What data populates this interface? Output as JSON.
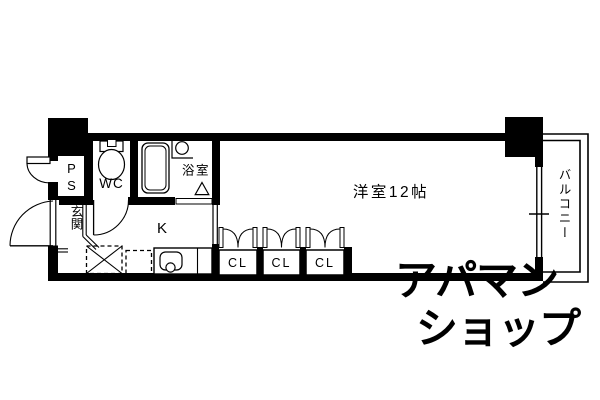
{
  "colors": {
    "line": "#000000",
    "background": "#ffffff",
    "watermark": "#e6e6e6"
  },
  "watermark": {
    "line1": "アパマン",
    "line2": "ショップ"
  },
  "floorplan": {
    "labels": {
      "pipe_space": "PS",
      "toilet": "WC",
      "bath": "浴室",
      "entrance": "玄関",
      "kitchen": "K",
      "main_room": "洋室12帖",
      "closet": "CL",
      "balcony": "バルコニー"
    }
  }
}
